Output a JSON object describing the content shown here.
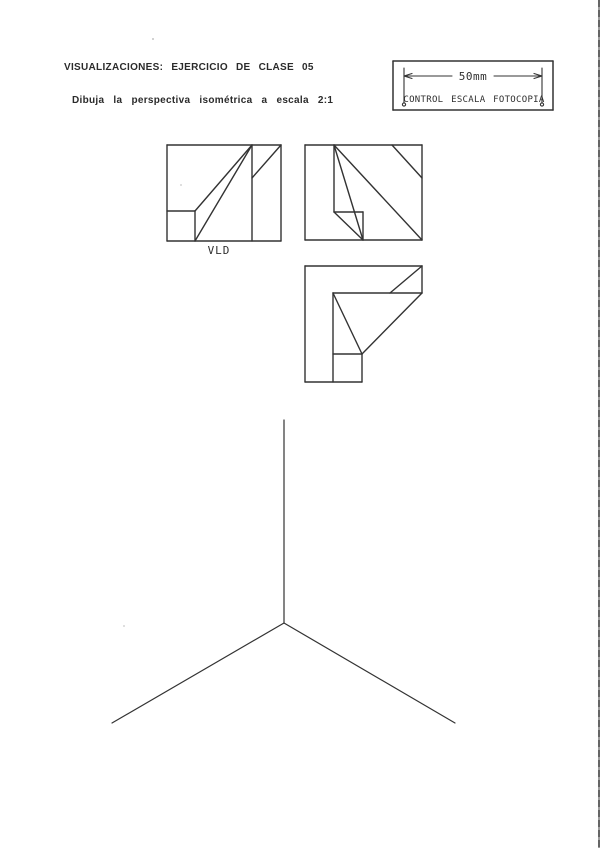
{
  "page": {
    "title": "VISUALIZACIONES: EJERCICIO DE CLASE 05",
    "subtitle": "Dibuja la perspectiva isométrica a escala 2:1"
  },
  "control_box": {
    "dimension_label": "50mm",
    "caption": "CONTROL ESCALA FOTOCOPIA"
  },
  "views": {
    "front_view_label": "VLD"
  },
  "drawing": {
    "stroke": "#333333",
    "groups": [
      {
        "id": "orthographic-view-front",
        "width": 1.4,
        "segments": [
          [
            167,
            145,
            281,
            145
          ],
          [
            281,
            145,
            281,
            241
          ],
          [
            167,
            241,
            281,
            241
          ],
          [
            167,
            145,
            167,
            241
          ],
          [
            252,
            145,
            252,
            241
          ],
          [
            252,
            178,
            281,
            145
          ],
          [
            252,
            145,
            195,
            211
          ],
          [
            252,
            145,
            195,
            241
          ],
          [
            167,
            211,
            195,
            211
          ],
          [
            195,
            211,
            195,
            241
          ]
        ]
      },
      {
        "id": "orthographic-view-side",
        "width": 1.4,
        "segments": [
          [
            305,
            145,
            422,
            145
          ],
          [
            422,
            145,
            422,
            240
          ],
          [
            305,
            240,
            422,
            240
          ],
          [
            305,
            145,
            305,
            240
          ],
          [
            334,
            145,
            334,
            212
          ],
          [
            334,
            212,
            363,
            212
          ],
          [
            363,
            212,
            363,
            240
          ],
          [
            334,
            145,
            363,
            240
          ],
          [
            334,
            212,
            363,
            240
          ],
          [
            334,
            145,
            422,
            240
          ],
          [
            392,
            145,
            422,
            178
          ]
        ]
      },
      {
        "id": "orthographic-view-top",
        "width": 1.4,
        "segments": [
          [
            305,
            266,
            422,
            266
          ],
          [
            305,
            266,
            305,
            382
          ],
          [
            305,
            382,
            362,
            382
          ],
          [
            422,
            266,
            422,
            293
          ],
          [
            333,
            293,
            422,
            293
          ],
          [
            390,
            293,
            422,
            266
          ],
          [
            422,
            293,
            362,
            354
          ],
          [
            333,
            293,
            333,
            382
          ],
          [
            333,
            354,
            362,
            354
          ],
          [
            362,
            354,
            362,
            382
          ],
          [
            333,
            293,
            362,
            354
          ]
        ]
      },
      {
        "id": "isometric-axes",
        "width": 1.2,
        "segments": [
          [
            284,
            420,
            284,
            623
          ],
          [
            284,
            623,
            112,
            723
          ],
          [
            284,
            623,
            455,
            723
          ]
        ]
      },
      {
        "id": "control-box-frame",
        "width": 1.5,
        "segments": [
          [
            393,
            61,
            553,
            61
          ],
          [
            553,
            61,
            553,
            110
          ],
          [
            393,
            110,
            553,
            110
          ],
          [
            393,
            61,
            393,
            110
          ]
        ]
      },
      {
        "id": "control-box-dimension",
        "width": 1.1,
        "segments": [
          [
            404,
            68,
            404,
            103
          ],
          [
            542,
            68,
            542,
            103
          ],
          [
            404,
            76,
            452,
            76
          ],
          [
            494,
            76,
            542,
            76
          ],
          [
            404,
            76,
            412,
            73.5
          ],
          [
            404,
            76,
            412,
            78.5
          ],
          [
            542,
            76,
            534,
            73.5
          ],
          [
            542,
            76,
            534,
            78.5
          ]
        ],
        "circles": [
          [
            404,
            104.5,
            1.6
          ],
          [
            542,
            104.5,
            1.6
          ]
        ]
      }
    ]
  }
}
